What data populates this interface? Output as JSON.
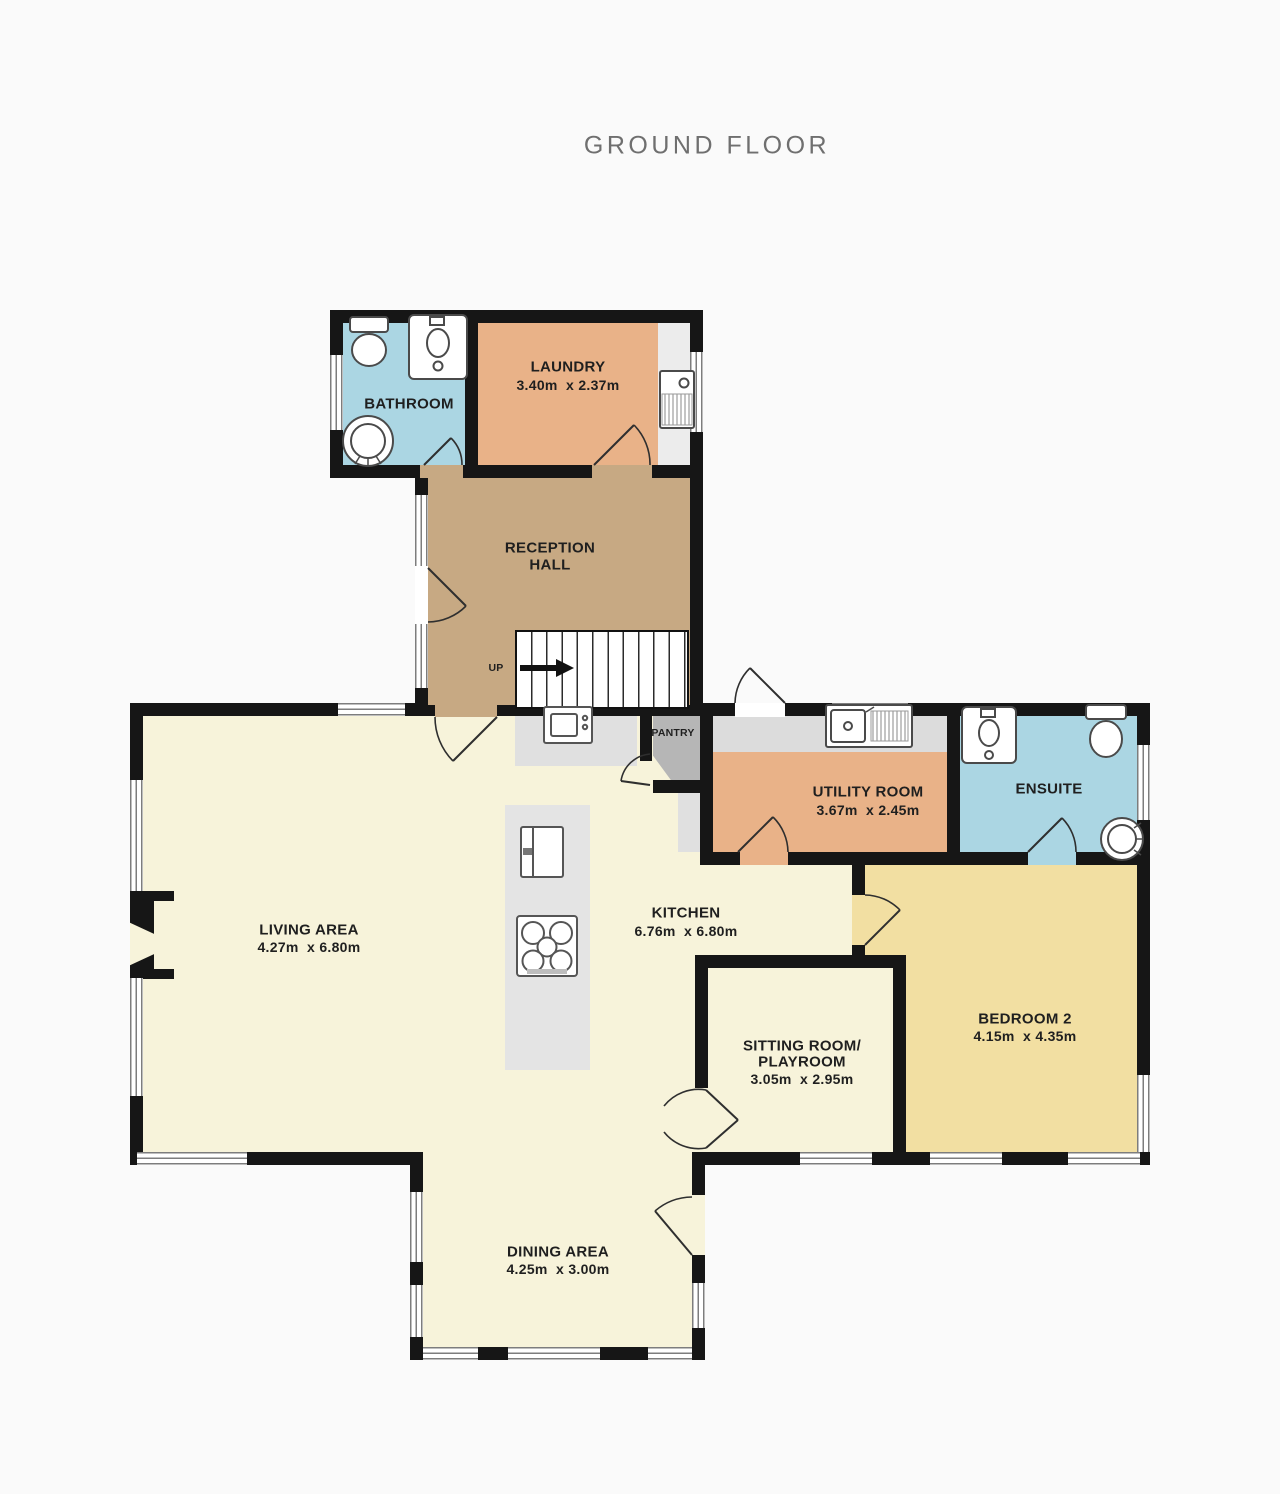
{
  "title": "GROUND FLOOR",
  "colors": {
    "wall": "#161616",
    "wet_room": "#abd6e3",
    "warm_room": "#e9b288",
    "hall": "#c7a983",
    "floor": "#f7f3da",
    "bedroom": "#f2dfa2",
    "pantry": "#b6b6b6",
    "counter": "#e0e0e0",
    "background": "#fafafa",
    "title_text": "#6f6f6f",
    "label_text": "#1f1f1f"
  },
  "rooms": {
    "bathroom": {
      "label": "BATHROOM"
    },
    "laundry": {
      "label": "LAUNDRY",
      "dims": "3.40m  x 2.37m"
    },
    "reception": {
      "label1": "RECEPTION",
      "label2": "HALL"
    },
    "pantry": {
      "label": "PANTRY"
    },
    "utility": {
      "label": "UTILITY ROOM",
      "dims": "3.67m  x 2.45m"
    },
    "ensuite": {
      "label": "ENSUITE"
    },
    "living": {
      "label": "LIVING AREA",
      "dims": "4.27m  x 6.80m"
    },
    "kitchen": {
      "label": "KITCHEN",
      "dims": "6.76m  x 6.80m"
    },
    "sitting": {
      "label1": "SITTING ROOM/",
      "label2": "PLAYROOM",
      "dims": "3.05m  x 2.95m"
    },
    "bedroom2": {
      "label": "BEDROOM 2",
      "dims": "4.15m  x 4.35m"
    },
    "dining": {
      "label": "DINING AREA",
      "dims": "4.25m  x 3.00m"
    }
  },
  "stairs": {
    "up_label": "UP"
  }
}
